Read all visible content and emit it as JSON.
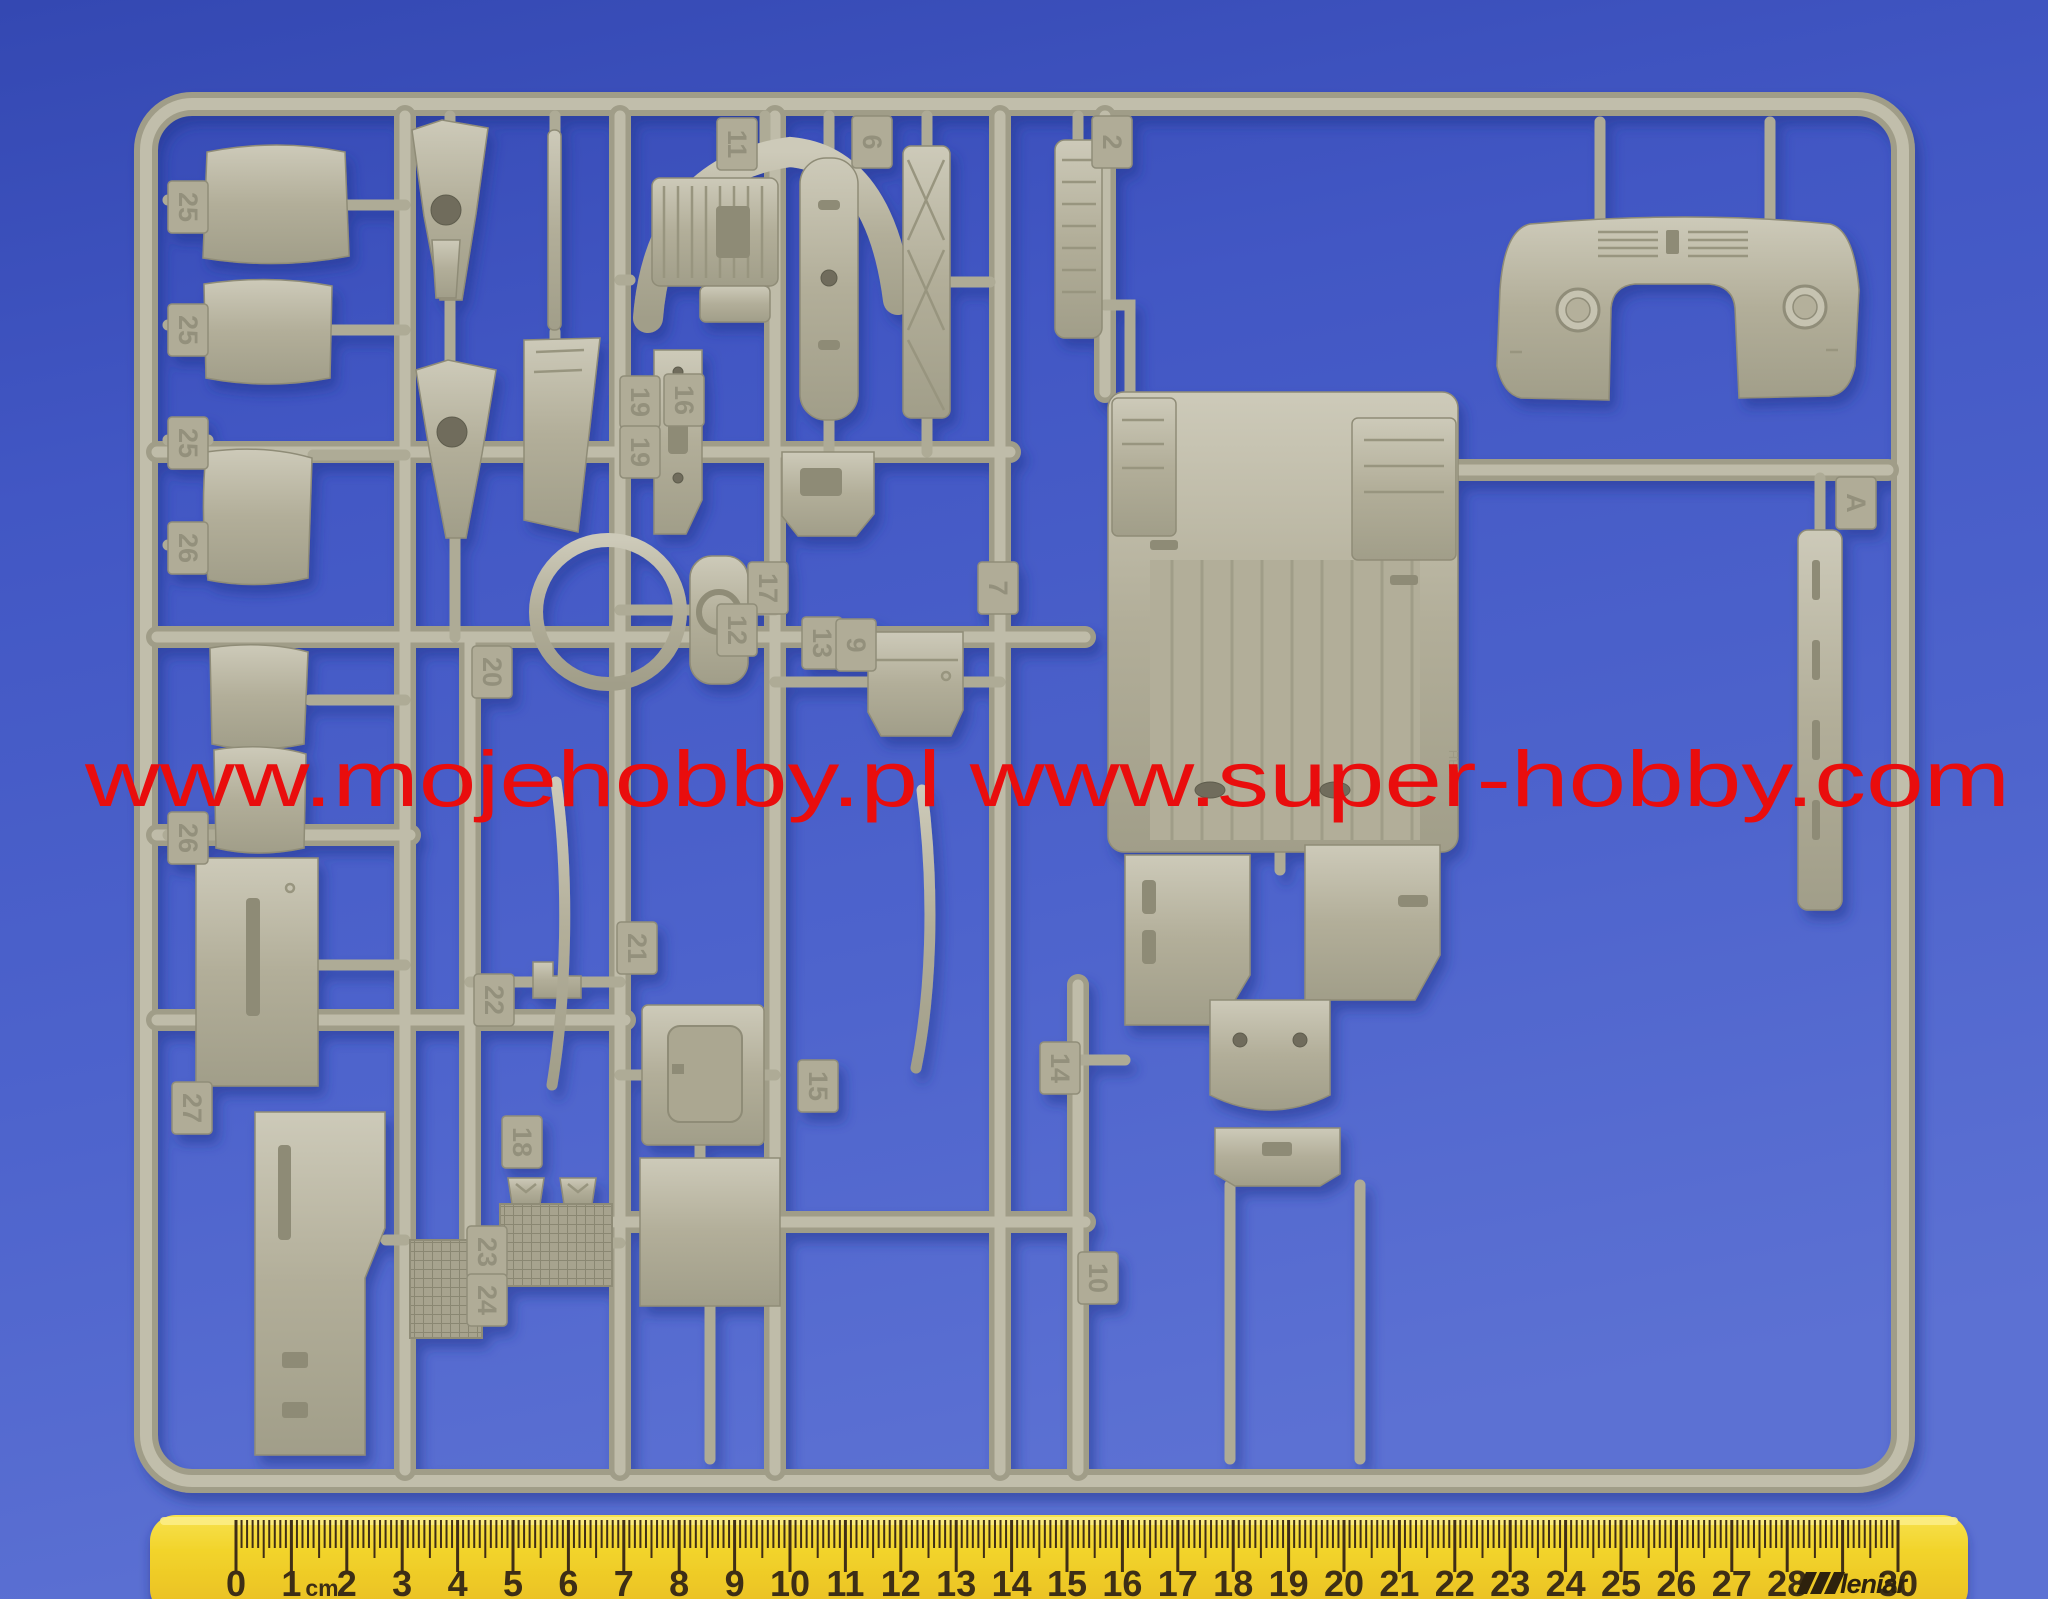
{
  "watermark": {
    "text": "www.mojehobby.pl www.super-hobby.com",
    "color": "#e90d0d"
  },
  "sprue": {
    "plastic_color": "#b5b19c",
    "gate_letter": "A",
    "molded_brand": "HELLER",
    "tags": [
      {
        "label": "25",
        "x": 188,
        "y": 207
      },
      {
        "label": "25",
        "x": 188,
        "y": 330
      },
      {
        "label": "25",
        "x": 188,
        "y": 443
      },
      {
        "label": "26",
        "x": 188,
        "y": 548
      },
      {
        "label": "26",
        "x": 188,
        "y": 838
      },
      {
        "label": "27",
        "x": 192,
        "y": 1108
      },
      {
        "label": "11",
        "x": 737,
        "y": 144
      },
      {
        "label": "6",
        "x": 872,
        "y": 142
      },
      {
        "label": "2",
        "x": 1112,
        "y": 142
      },
      {
        "label": "19",
        "x": 640,
        "y": 402
      },
      {
        "label": "16",
        "x": 684,
        "y": 400
      },
      {
        "label": "19",
        "x": 640,
        "y": 452
      },
      {
        "label": "17",
        "x": 768,
        "y": 588
      },
      {
        "label": "7",
        "x": 998,
        "y": 588
      },
      {
        "label": "20",
        "x": 492,
        "y": 672
      },
      {
        "label": "12",
        "x": 737,
        "y": 630
      },
      {
        "label": "13",
        "x": 822,
        "y": 643
      },
      {
        "label": "9",
        "x": 856,
        "y": 645
      },
      {
        "label": "21",
        "x": 637,
        "y": 948
      },
      {
        "label": "22",
        "x": 494,
        "y": 1000
      },
      {
        "label": "15",
        "x": 818,
        "y": 1086
      },
      {
        "label": "18",
        "x": 522,
        "y": 1142
      },
      {
        "label": "23",
        "x": 487,
        "y": 1252
      },
      {
        "label": "24",
        "x": 487,
        "y": 1300
      },
      {
        "label": "14",
        "x": 1060,
        "y": 1068
      },
      {
        "label": "10",
        "x": 1098,
        "y": 1278
      },
      {
        "label": "A",
        "x": 1856,
        "y": 503
      }
    ]
  },
  "ruler": {
    "numbers": [
      "0",
      "1",
      "2",
      "3",
      "4",
      "5",
      "6",
      "7",
      "8",
      "9",
      "10",
      "11",
      "12",
      "13",
      "14",
      "15",
      "16",
      "17",
      "18",
      "19",
      "20",
      "21",
      "22",
      "23",
      "24",
      "25",
      "26",
      "27",
      "28",
      "",
      "30"
    ],
    "unit_label": "cm",
    "brand": "leniar",
    "body_color": "#f2d42b",
    "tick_color": "#3f2f12"
  }
}
